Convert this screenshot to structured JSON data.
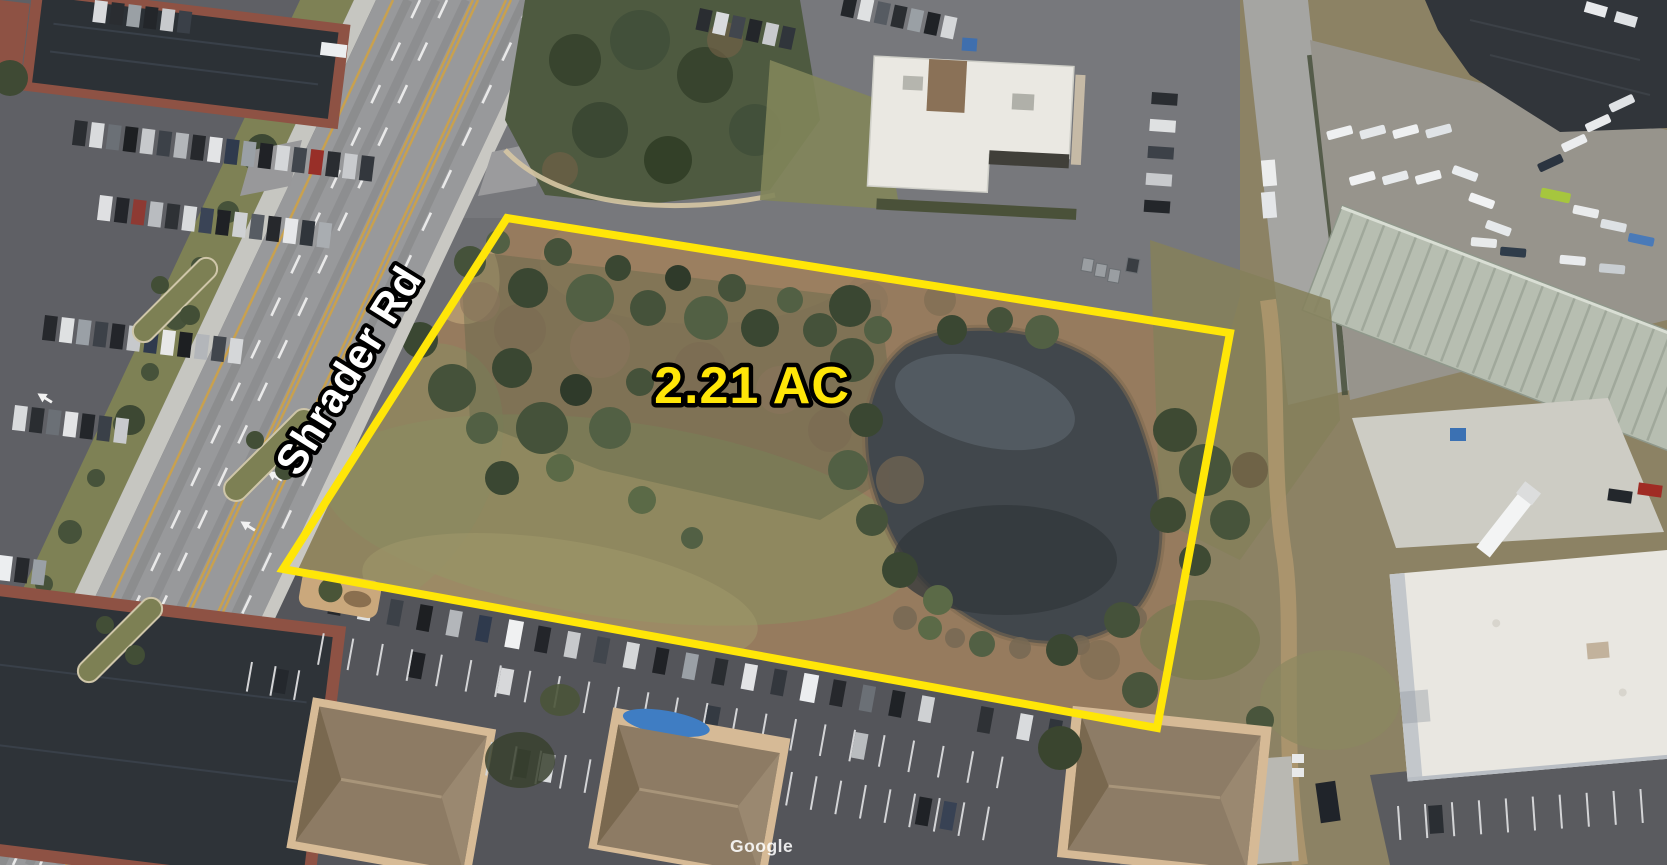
{
  "map": {
    "road_label": "Shrader Rd",
    "acreage_label": "2.21 AC",
    "watermark": "Google",
    "colors": {
      "boundary": "#FFE608",
      "acreage_text": "#FFE608",
      "road_label_text": "#FFFFFF",
      "label_outline": "#000000"
    }
  }
}
